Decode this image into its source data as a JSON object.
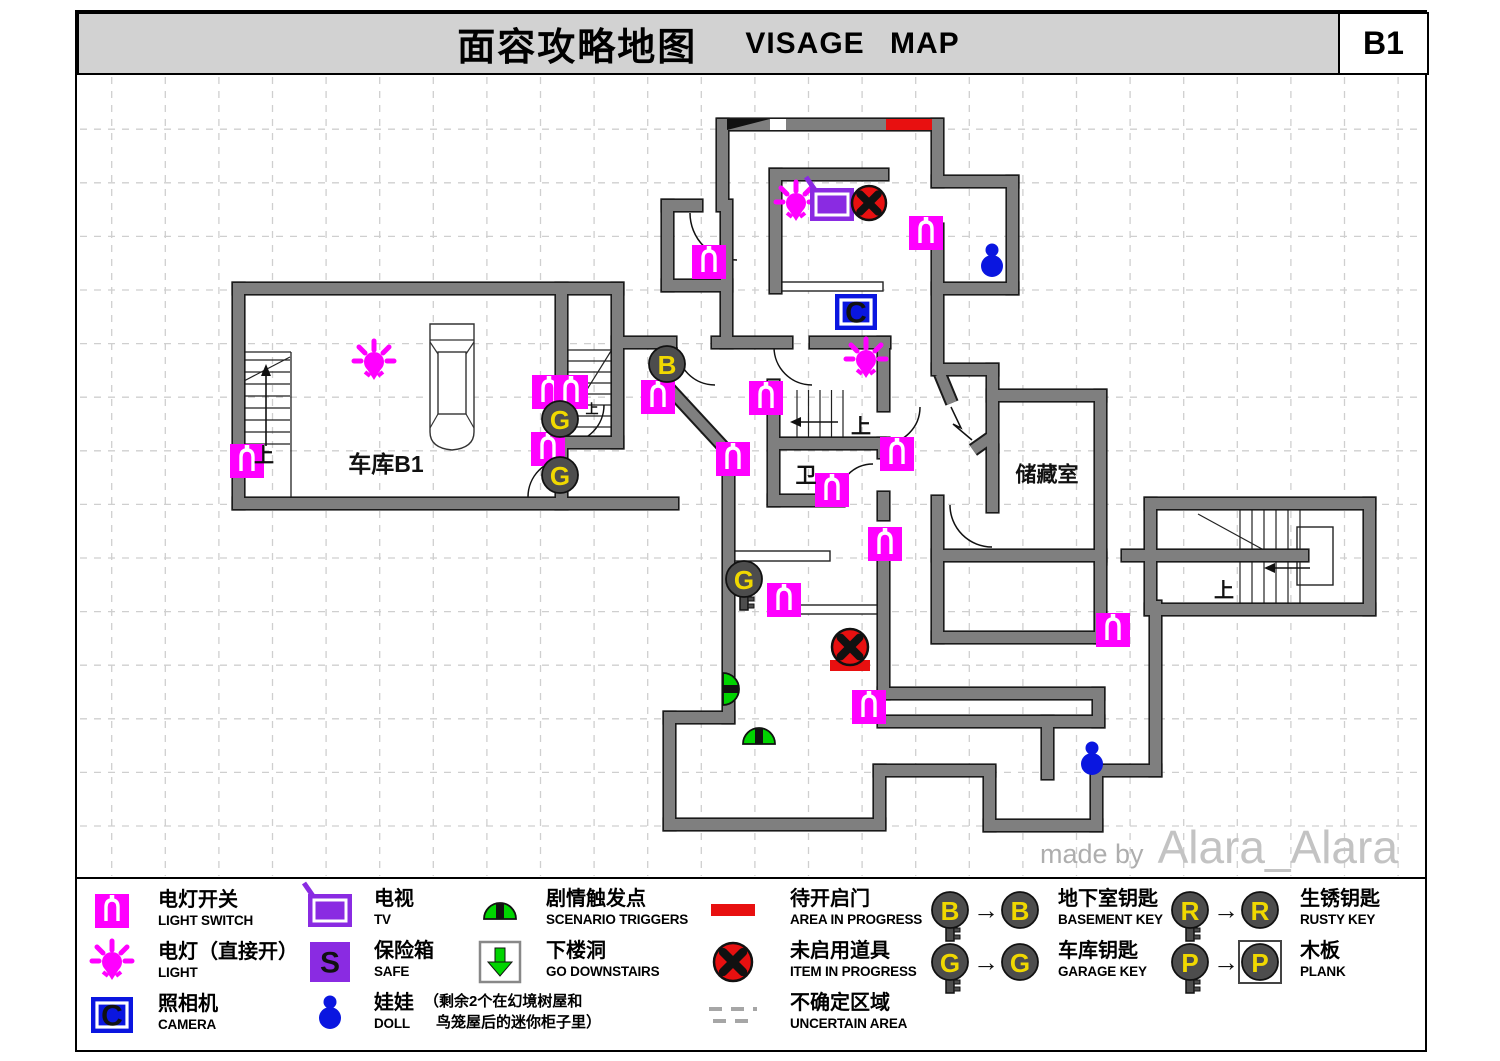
{
  "header": {
    "title_cn": "面容攻略地图",
    "title_en": "VISAGE MAP",
    "floor": "B1"
  },
  "watermark": {
    "prefix": "made by",
    "name": "Alara_Alara"
  },
  "glyphs": {
    "camera": "C",
    "safe": "S"
  },
  "colors": {
    "magenta": "#ff00ff",
    "purple": "#8a2be2",
    "blue": "#0a16e0",
    "green": "#00d400",
    "red": "#e81010",
    "key_gray": "#4d4d4d",
    "key_yellow": "#f0d800",
    "wall": "#7f7f7f",
    "wall_outline": "#1a1a1a",
    "grid": "#cfcfcf",
    "header_bg": "#d2d2d2"
  },
  "map": {
    "grid": {
      "x0": 58.1,
      "y0": 75.6,
      "step": 53.6
    },
    "walls": [
      [
        718,
        119,
        224,
        11
      ],
      [
        932,
        119,
        11,
        68
      ],
      [
        932,
        176,
        86,
        11
      ],
      [
        1007,
        176,
        11,
        118
      ],
      [
        932,
        283,
        86,
        11
      ],
      [
        932,
        224,
        11,
        148
      ],
      [
        717,
        119,
        11,
        92
      ],
      [
        662,
        200,
        40,
        11
      ],
      [
        662,
        200,
        11,
        91
      ],
      [
        662,
        280,
        70,
        11
      ],
      [
        721,
        200,
        11,
        148
      ],
      [
        770,
        169,
        118,
        11
      ],
      [
        770,
        169,
        11,
        124
      ],
      [
        612,
        337,
        64,
        11
      ],
      [
        712,
        337,
        80,
        11
      ],
      [
        810,
        337,
        80,
        11
      ],
      [
        878,
        337,
        11,
        74
      ],
      [
        878,
        438,
        11,
        20
      ],
      [
        878,
        492,
        11,
        28
      ],
      [
        768,
        380,
        11,
        126
      ],
      [
        775,
        438,
        110,
        11
      ],
      [
        768,
        495,
        76,
        11
      ],
      [
        932,
        364,
        66,
        11
      ],
      [
        987,
        364,
        11,
        88
      ],
      [
        987,
        390,
        119,
        11
      ],
      [
        1095,
        390,
        11,
        174
      ],
      [
        987,
        445,
        11,
        67
      ],
      [
        932,
        496,
        11,
        147
      ],
      [
        932,
        550,
        174,
        11
      ],
      [
        932,
        632,
        174,
        11
      ],
      [
        1095,
        553,
        11,
        90
      ],
      [
        878,
        543,
        11,
        156
      ],
      [
        878,
        688,
        226,
        11
      ],
      [
        878,
        716,
        226,
        11
      ],
      [
        1093,
        688,
        11,
        39
      ],
      [
        1042,
        716,
        11,
        63
      ],
      [
        1150,
        601,
        11,
        175
      ],
      [
        1096,
        765,
        65,
        11
      ],
      [
        1091,
        765,
        11,
        66
      ],
      [
        984,
        820,
        118,
        11
      ],
      [
        984,
        767,
        11,
        64
      ],
      [
        874,
        765,
        121,
        11
      ],
      [
        874,
        765,
        11,
        63
      ],
      [
        664,
        819,
        221,
        11
      ],
      [
        664,
        712,
        11,
        118
      ],
      [
        664,
        712,
        70,
        11
      ],
      [
        723,
        446,
        11,
        277
      ],
      [
        233,
        283,
        390,
        11
      ],
      [
        233,
        283,
        11,
        226
      ],
      [
        233,
        498,
        445,
        11
      ],
      [
        612,
        283,
        11,
        165
      ],
      [
        556,
        283,
        11,
        116
      ],
      [
        556,
        437,
        11,
        22
      ],
      [
        556,
        485,
        11,
        24
      ],
      [
        556,
        437,
        67,
        11
      ],
      [
        1145,
        498,
        230,
        11
      ],
      [
        1364,
        498,
        11,
        117
      ],
      [
        1145,
        604,
        230,
        11
      ],
      [
        1145,
        498,
        11,
        117
      ],
      [
        1122,
        550,
        186,
        11
      ]
    ],
    "diag_walls": [
      [
        667,
        386,
        728,
        452
      ],
      [
        940,
        374,
        952,
        403
      ],
      [
        973,
        450,
        990,
        438
      ]
    ],
    "door_arcs": [
      "M690,213 A47,47 0 0 0 737,260",
      "M677,347 A38,38 0 0 0 715,385",
      "M774,347 A38,38 0 0 0 812,385",
      "M920,407 A37,37 0 0 1 883,444",
      "M838,499 A35,35 0 0 1 873,464",
      "M604,405 A38,38 0 0 1 566,443",
      "M566,459 A38,38 0 0 0 528,497",
      "M950,505 A42,42 0 0 0 992,547"
    ],
    "zigzag": "M951,407 L961,428 L953,424 L972,440",
    "shelves": [
      [
        780,
        282,
        103,
        9
      ],
      [
        728,
        551,
        102,
        10
      ],
      [
        777,
        605,
        106,
        9
      ],
      [
        1297,
        527,
        36,
        58
      ]
    ],
    "thin_lines": [
      [
        291,
        352,
        291,
        497
      ],
      [
        240,
        352,
        291,
        352
      ]
    ],
    "stairs": [
      {
        "x": 242,
        "y": 360,
        "len": 48,
        "count": 8,
        "gap": 12,
        "dir": "h"
      },
      {
        "x": 568,
        "y": 350,
        "len": 44,
        "count": 8,
        "gap": 11,
        "dir": "h"
      },
      {
        "x": 797,
        "y": 390,
        "len": 57,
        "count": 5,
        "gap": 11.5,
        "dir": "v"
      },
      {
        "x": 1240,
        "y": 509,
        "len": 42,
        "count": 6,
        "gap": 12,
        "dir": "v"
      },
      {
        "x": 1240,
        "y": 561,
        "len": 43,
        "count": 6,
        "gap": 12,
        "dir": "v"
      }
    ],
    "stair_cuts": [
      [
        242,
        382,
        290,
        357
      ],
      [
        568,
        420,
        611,
        351
      ],
      [
        1198,
        514,
        1262,
        549
      ]
    ],
    "stair_arrows": [
      {
        "line": [
          266,
          446,
          266,
          374
        ],
        "head": "266,364 261,376 271,376"
      },
      {
        "line": [
          800,
          422,
          838,
          422
        ],
        "head": "790,422 801,417 801,427"
      },
      {
        "line": [
          1274,
          568,
          1310,
          568
        ],
        "head": "1264,568 1275,563 1275,573"
      }
    ],
    "car": {
      "x": 427,
      "y": 322
    },
    "wedge": {
      "points": "727,119 770,119 727,130",
      "slot": [
        770,
        119,
        16,
        11
      ]
    },
    "red_rects": [
      [
        886,
        119,
        46,
        11
      ],
      [
        830,
        660,
        40,
        11
      ]
    ],
    "icons": {
      "switches": [
        [
          709,
          262
        ],
        [
          926,
          233
        ],
        [
          247,
          461
        ],
        [
          549,
          392
        ],
        [
          571,
          392
        ],
        [
          548,
          449
        ],
        [
          658,
          397
        ],
        [
          766,
          398
        ],
        [
          733,
          459
        ],
        [
          832,
          490
        ],
        [
          897,
          454
        ],
        [
          885,
          544
        ],
        [
          784,
          600
        ],
        [
          869,
          707
        ],
        [
          1113,
          630
        ]
      ],
      "lights": [
        [
          374,
          363
        ],
        [
          796,
          204
        ],
        [
          866,
          361
        ]
      ],
      "tvs": [
        [
          832,
          204
        ]
      ],
      "cameras": [
        [
          856,
          312
        ]
      ],
      "xs": [
        [
          869,
          203,
          17
        ],
        [
          850,
          647,
          18
        ]
      ],
      "dolls": [
        [
          992,
          262
        ],
        [
          1092,
          760
        ]
      ],
      "keys": [
        {
          "x": 667,
          "y": 364,
          "letter": "B",
          "tail": false
        },
        {
          "x": 560,
          "y": 419,
          "letter": "G",
          "tail": false
        },
        {
          "x": 560,
          "y": 475,
          "letter": "G",
          "tail": false
        },
        {
          "x": 744,
          "y": 579,
          "letter": "G",
          "tail": true
        }
      ],
      "triggers": [
        {
          "x": 732,
          "y": 689,
          "o": "right"
        },
        {
          "x": 759,
          "y": 735,
          "o": "up"
        }
      ]
    },
    "labels": [
      {
        "t": "车库B1",
        "x": 386,
        "y": 464,
        "s": 23
      },
      {
        "t": "卫",
        "x": 806,
        "y": 476,
        "s": 21
      },
      {
        "t": "储藏室",
        "x": 1047,
        "y": 475,
        "s": 21
      },
      {
        "t": "上",
        "x": 264,
        "y": 456,
        "s": 20
      },
      {
        "t": "上",
        "x": 592,
        "y": 409,
        "s": 13
      },
      {
        "t": "上",
        "x": 861,
        "y": 427,
        "s": 20
      },
      {
        "t": "上",
        "x": 1224,
        "y": 591,
        "s": 20
      }
    ]
  },
  "legend": {
    "arrow": "→",
    "cols": [
      {
        "x": 112,
        "tx": 158,
        "items": [
          {
            "icon": "light-switch",
            "cn": "电灯开关",
            "en": "LIGHT SWITCH",
            "y": 911
          },
          {
            "icon": "light",
            "cn": "电灯（直接开）",
            "en": "LIGHT",
            "y": 963
          },
          {
            "icon": "camera",
            "cn": "照相机",
            "en": "CAMERA",
            "y": 1015
          }
        ]
      },
      {
        "x": 330,
        "tx": 374,
        "items": [
          {
            "icon": "tv",
            "cn": "电视",
            "en": "TV",
            "y": 910
          },
          {
            "icon": "safe",
            "cn": "保险箱",
            "en": "SAFE",
            "y": 962
          },
          {
            "icon": "doll",
            "cn": "娃娃",
            "en": "DOLL",
            "y": 1014,
            "note1": "（剩余2个在幻境树屋和",
            "note2": "鸟笼屋后的迷你柜子里）"
          }
        ]
      },
      {
        "x": 500,
        "tx": 546,
        "items": [
          {
            "icon": "trigger",
            "cn": "剧情触发点",
            "en": "SCENARIO TRIGGERS",
            "y": 910
          },
          {
            "icon": "downstairs",
            "cn": "下楼洞",
            "en": "GO DOWNSTAIRS",
            "y": 962
          }
        ]
      },
      {
        "x": 733,
        "tx": 790,
        "items": [
          {
            "icon": "red-bar",
            "cn": "待开启门",
            "en": "AREA IN PROGRESS",
            "y": 910
          },
          {
            "icon": "red-x",
            "cn": "未启用道具",
            "en": "ITEM IN PROGRESS",
            "y": 962
          },
          {
            "icon": "uncertain",
            "cn": "不确定区域",
            "en": "UNCERTAIN AREA",
            "y": 1014
          }
        ]
      },
      {
        "x": 950,
        "tx": 1058,
        "items": [
          {
            "icon": "key",
            "letter": "B",
            "boxed": false,
            "cn": "地下室钥匙",
            "en": "BASEMENT KEY",
            "y": 910
          },
          {
            "icon": "key",
            "letter": "G",
            "boxed": false,
            "cn": "车库钥匙",
            "en": "GARAGE KEY",
            "y": 962
          }
        ]
      },
      {
        "x": 1190,
        "tx": 1300,
        "items": [
          {
            "icon": "key",
            "letter": "R",
            "boxed": false,
            "cn": "生锈钥匙",
            "en": "RUSTY KEY",
            "y": 910
          },
          {
            "icon": "key",
            "letter": "P",
            "boxed": true,
            "cn": "木板",
            "en": "PLANK",
            "y": 962
          }
        ]
      }
    ]
  }
}
